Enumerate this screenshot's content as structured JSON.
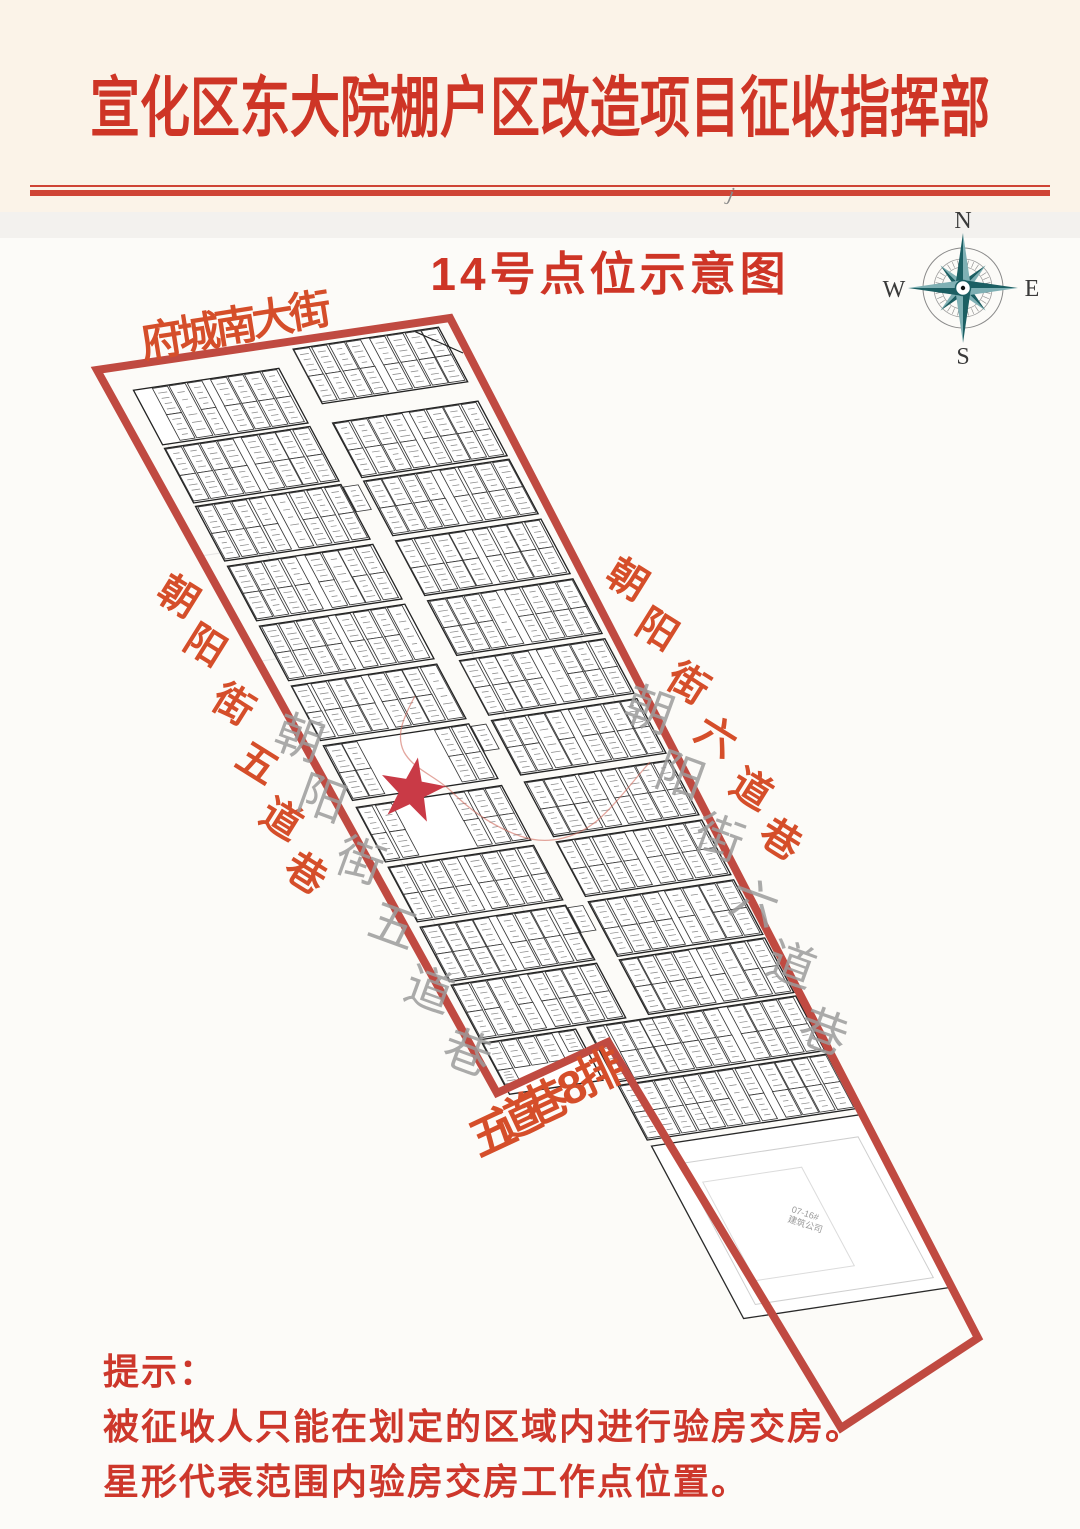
{
  "header": {
    "title": "宣化区东大院棚户区改造项目征收指挥部"
  },
  "subtitle": "14号点位示意图",
  "compass": {
    "n": "N",
    "e": "E",
    "s": "S",
    "w": "W"
  },
  "streets": {
    "top": "府城南大街",
    "left": "朝阳街五道巷",
    "right": "朝阳街六道巷",
    "bottom": "五道巷8排",
    "inner_left": "朝阳街五道巷",
    "inner_right": "朝阳街六道巷"
  },
  "construction_block": {
    "line1": "07-16#",
    "line2": "建筑公司"
  },
  "stray_mark": "j",
  "tip": {
    "heading": "提示：",
    "line1": "被征收人只能在划定的区域内进行验房交房。",
    "line2": "星形代表范围内验房交房工作点位置。"
  },
  "colors": {
    "border_red": "#c04a41",
    "title_red": "#ce3526",
    "label_red": "#d54e2a",
    "tip_red": "#cd372b",
    "star_red": "#c93a46",
    "rule_red": "#cf4435",
    "compass_dark": "#1c5f63",
    "compass_light": "#7fb0b4",
    "street_gray": "#9c9c9c",
    "header_bg": "#fbf3e8"
  }
}
